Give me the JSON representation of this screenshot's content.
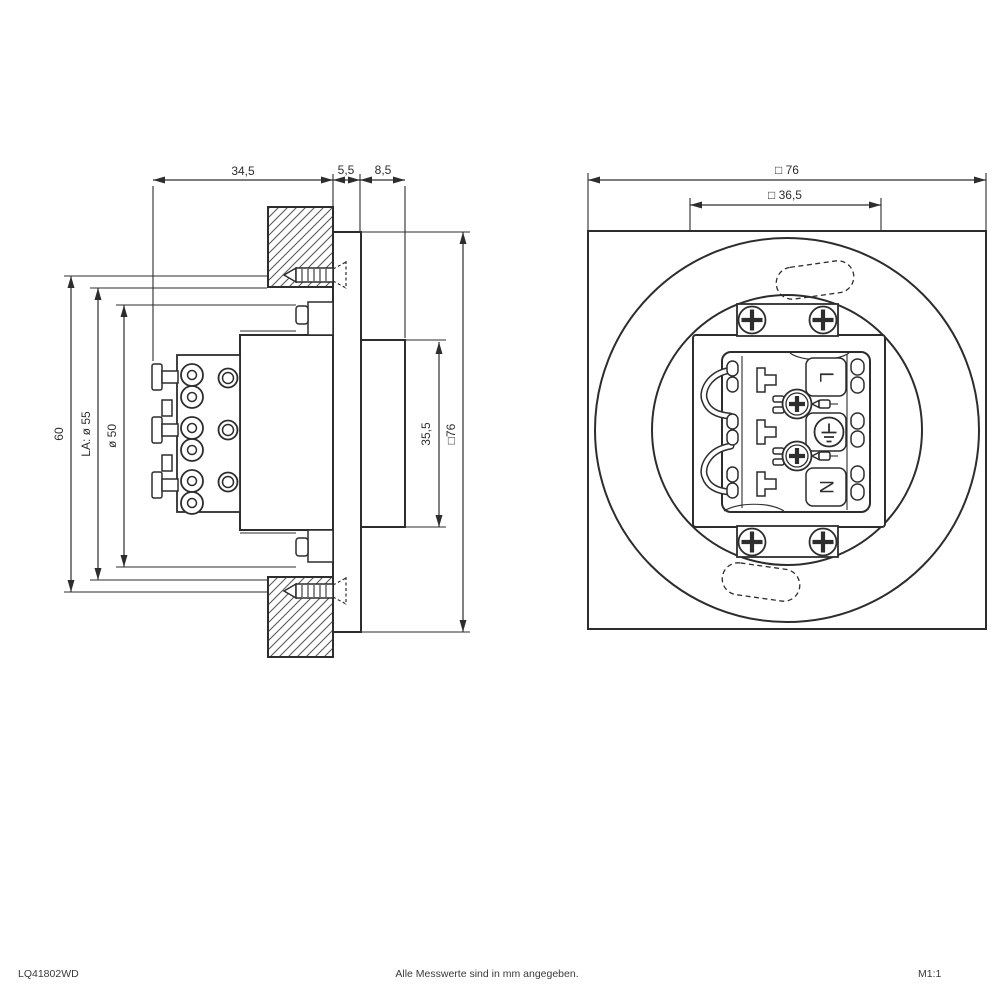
{
  "side_view": {
    "dim_recess_depth": "34,5",
    "dim_bezel_thickness": "5,5",
    "dim_front_depth": "8,5",
    "dim_screw_spacing": "60",
    "dim_cutout": "LA: ø 55",
    "dim_inner_clearance": "ø 50",
    "dim_front_height": "35,5",
    "dim_bezel_size": "□76"
  },
  "front_view": {
    "dim_faceplate": "□ 76",
    "dim_mounting_plate": "□ 36,5",
    "terminal_live_label": "L",
    "terminal_neutral_label": "N"
  },
  "footer": {
    "product_code": "LQ41802WD",
    "measurement_note": "Alle Messwerte sind in mm angegeben.",
    "scale": "M1:1"
  },
  "colors": {
    "line": "#2d2d2d",
    "background": "#ffffff"
  }
}
